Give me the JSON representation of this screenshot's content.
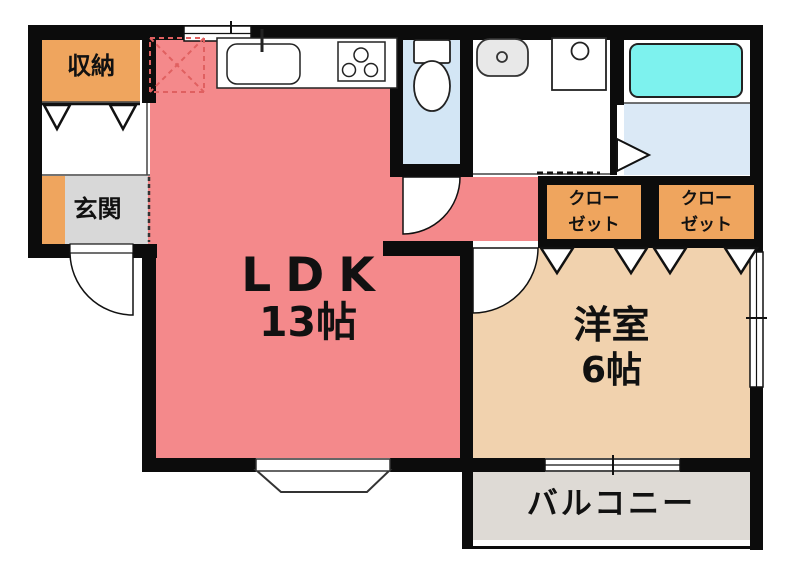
{
  "plan_title": "1LDK apartment floor plan",
  "rooms": {
    "storage": {
      "label": "収納"
    },
    "entrance": {
      "label": "玄関"
    },
    "ldk": {
      "label": "LDK",
      "size": "13帖"
    },
    "western_room": {
      "label": "洋室",
      "size": "6帖"
    },
    "closet1": {
      "label_line1": "クロー",
      "label_line2": "ゼット"
    },
    "closet2": {
      "label_line1": "クロー",
      "label_line2": "ゼット"
    },
    "balcony": {
      "label": "バルコニー"
    }
  },
  "fixtures": [
    "kitchen-counter",
    "kitchen-sink",
    "stove",
    "refrigerator-space",
    "toilet",
    "washbasin",
    "washing-machine",
    "bathtub",
    "entrance-door",
    "toilet-door",
    "western-room-door",
    "bath-folding-door",
    "bay-window",
    "kitchen-window",
    "side-window",
    "balcony-sliding-door",
    "closet-folding-doors"
  ],
  "colors": {
    "wall": "#0c0c0c",
    "ldk_floor": "#f4898b",
    "western_room_floor": "#f1d2ae",
    "closet_fill": "#efa55e",
    "storage_fill": "#efa55e",
    "entrance_strip": "#efa55e",
    "entrance_floor": "#d8d8d8",
    "balcony_floor": "#dedad5",
    "toilet_floor": "#d3e6f5",
    "bath_floor": "#dbe9f6",
    "bathtub": "#7df2ee",
    "fridge_dash": "#e06060",
    "fixture_gray": "#e8e8e8"
  }
}
